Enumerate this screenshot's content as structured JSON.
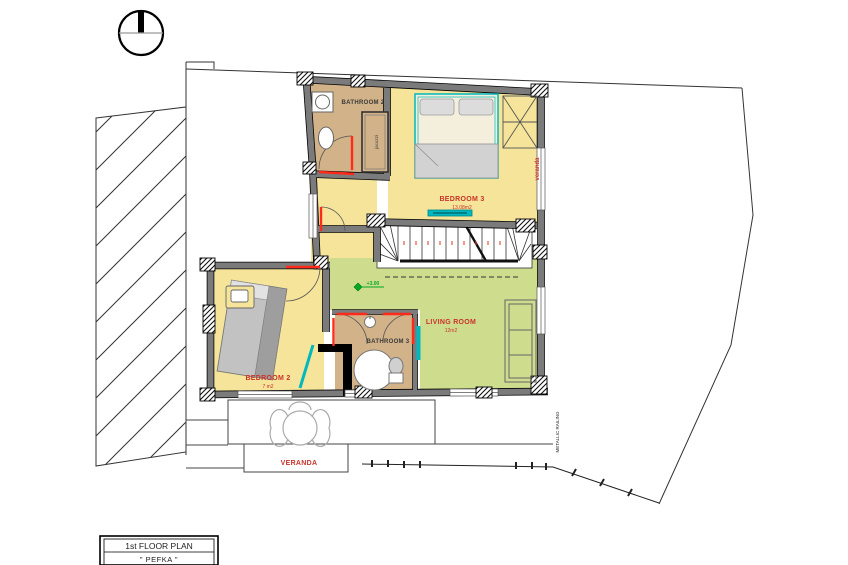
{
  "drawing": {
    "title_block": {
      "line1": "1st FLOOR PLAN",
      "line2": "\" PEFKA \""
    },
    "rooms": {
      "bathroom2": {
        "label": "BATHROOM 2"
      },
      "bedroom3": {
        "label": "BEDROOM 3",
        "area": "13.08m2"
      },
      "bedroom2": {
        "label": "BEDROOM 2",
        "area": "7 m2"
      },
      "bathroom3": {
        "label": "BATHROOM 3"
      },
      "living_room": {
        "label": "LIVING ROOM",
        "area": "12m2"
      },
      "veranda": {
        "label": "VERANDA"
      },
      "veranda_side": {
        "label": "veranda"
      }
    },
    "annotations": {
      "jacuzzi": "jacuzzi",
      "level": "+3.00",
      "railing_note": "METALLIC RAILING"
    },
    "symbols": {
      "north": "north-arrow"
    },
    "colors": {
      "floor_yellow": "#F5E499",
      "floor_tan": "#D2B288",
      "floor_green": "#CEDC8E",
      "wall_gray": "#7B7B7B",
      "label_red": "#C9342A",
      "door_red": "#FF2B1A",
      "fixture_teal": "#00B8BE",
      "level_green": "#00AA22"
    }
  }
}
